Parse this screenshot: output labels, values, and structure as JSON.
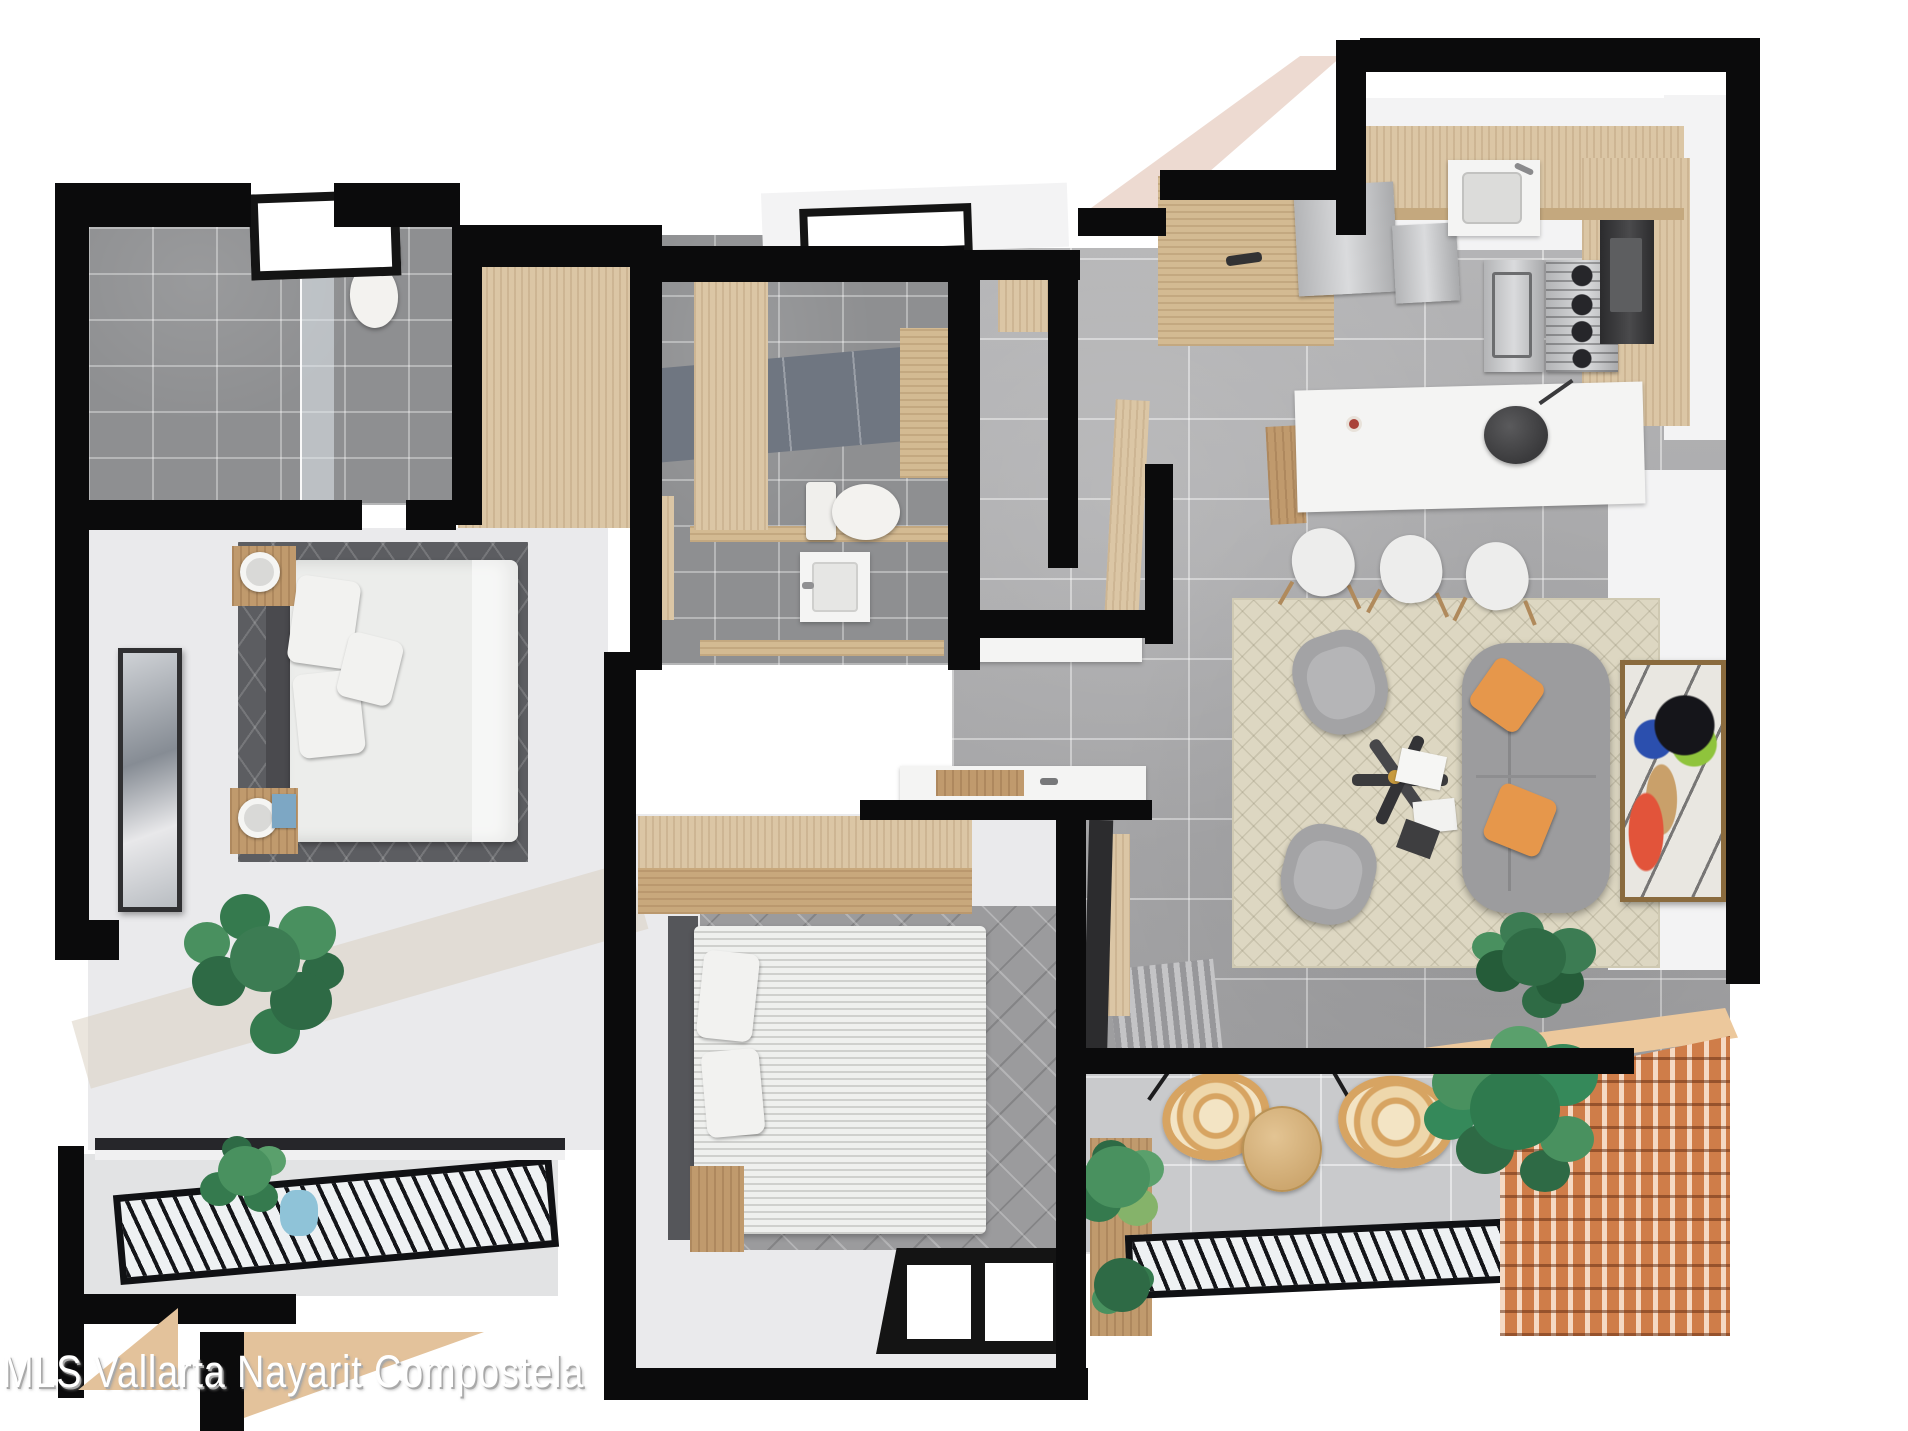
{
  "watermark": {
    "text": "MLS Vallarta Nayarit Compostela"
  },
  "logo": {
    "bar_color": "#0b0b0c",
    "triangle_color": "#e3c29b"
  },
  "palette": {
    "background": "#ffffff",
    "wall_black": "#0b0b0c",
    "floor_tile_gray": "#a6a6a8",
    "balcony_tile_gray": "#c9cacc",
    "bath_tile_gray": "#8e8f91",
    "bath_accent_band": "#6f7681",
    "wood_light": "#dbc6a5",
    "wood_mid": "#c09a6d",
    "peach_wall": "#eddad1",
    "rug_cream": "#ddd7c2",
    "bedroom_accent_rug": "#5c5d61",
    "sofa_gray": "#9c9c9e",
    "pillow_orange": "#e6974b",
    "plant_green": "#3c7c53",
    "rattan": "#d7a462",
    "lattice_terracotta": "#cf7d49",
    "stainless": "#c0c1c3",
    "watermark_shadow": "#a9a9a9",
    "pot_blue": "#8fc3d8"
  },
  "scene": {
    "type": "apartment-floor-plan-3d-render",
    "view": "top-down",
    "rooms": [
      {
        "name": "master-bathroom",
        "features": [
          "shower-glass",
          "toilet",
          "window"
        ]
      },
      {
        "name": "walk-in-closet",
        "features": [
          "wood-cabinets"
        ]
      },
      {
        "name": "second-bathroom",
        "features": [
          "toilet",
          "sink",
          "wood-cabinet",
          "window"
        ]
      },
      {
        "name": "hallway",
        "features": [
          "wood-doors",
          "console"
        ]
      },
      {
        "name": "master-bedroom",
        "features": [
          "double-bed",
          "nightstands",
          "lamps",
          "wall-art",
          "monstera-plant",
          "accent-rug",
          "balcony"
        ]
      },
      {
        "name": "second-bedroom",
        "features": [
          "double-bed",
          "wardrobe",
          "nightstand",
          "tv-panel",
          "window"
        ]
      },
      {
        "name": "kitchen",
        "features": [
          "l-counter",
          "sink",
          "cooktop",
          "oven",
          "fridge",
          "island",
          "bar-stools"
        ]
      },
      {
        "name": "living-dining",
        "features": [
          "sofa",
          "armchairs",
          "coffee-table",
          "rug",
          "wall-art",
          "plant"
        ]
      },
      {
        "name": "terrace",
        "features": [
          "hanging-chairs",
          "round-table",
          "palm-plants",
          "wood-lattice",
          "railing"
        ]
      }
    ]
  }
}
